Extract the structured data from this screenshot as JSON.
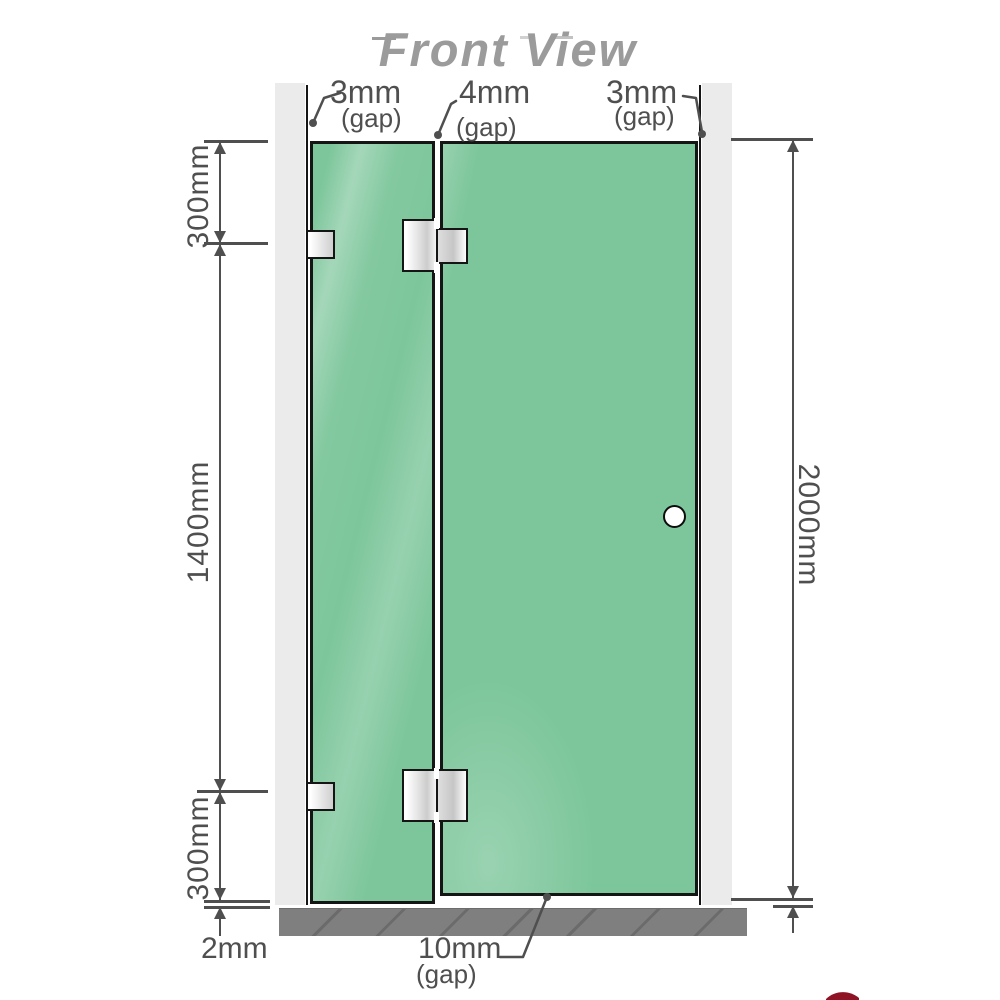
{
  "title": "Front View",
  "labels": {
    "gap_top_left": {
      "value": "3mm",
      "suffix": "(gap)"
    },
    "gap_top_middle": {
      "value": "4mm",
      "suffix": "(gap)"
    },
    "gap_top_right": {
      "value": "3mm",
      "suffix": "(gap)"
    },
    "height_top_segment": "300mm",
    "height_middle_segment": "1400mm",
    "height_bottom_segment": "300mm",
    "gap_bottom_left": "2mm",
    "gap_bottom_middle": {
      "value": "10mm",
      "suffix": "(gap)"
    },
    "total_height": "2000mm"
  },
  "colors": {
    "glass": "#7dc69b",
    "wall": "#ebebeb",
    "floor": "#7f7f7f",
    "dimension": "#4f4f4f",
    "title_gray": "#9b9b9b",
    "accent_red": "#8e1325"
  }
}
